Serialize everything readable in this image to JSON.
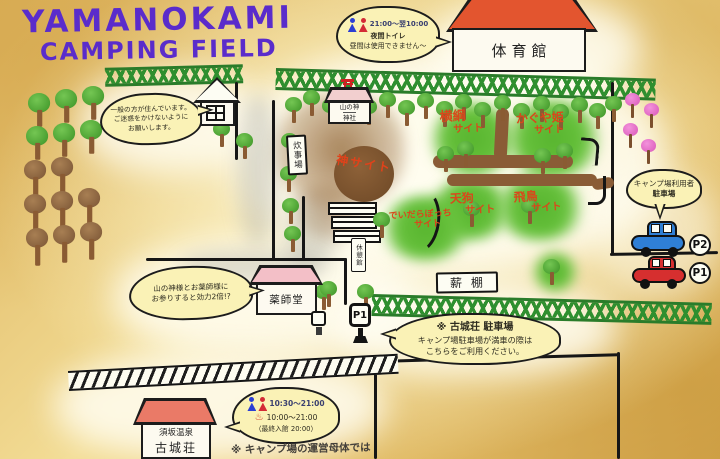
{
  "title": {
    "line1": "YAMANOKAMI",
    "line2": "CAMPING FIELD"
  },
  "buildings": {
    "gym": "体育館",
    "shrine_line1": "山の神",
    "shrine_line2": "神社",
    "cooking": "炊事場",
    "rest_hut": "休憩館",
    "yakushido": "薬師堂",
    "woodshed": "薪棚",
    "kojoso_line1": "須坂温泉",
    "kojoso_line2": "古城荘"
  },
  "sites": {
    "kami": "神サイト",
    "yokozuna": "横綱",
    "kaguya": "かぐや姫",
    "tengu": "天狗",
    "asuka": "飛鳥",
    "deidarabotchi": "でいだらぼっち",
    "suffix": "サイト"
  },
  "bubbles": {
    "night_toilet": {
      "time": "21:00〜翌10:00",
      "line1": "夜間トイレ",
      "line2": "昼間は使用できません〜"
    },
    "residents": {
      "line1": "一般の方が住んでいます。",
      "line2": "ご迷惑をかけないように",
      "line3": "お願いします。"
    },
    "pray": {
      "line1": "山の神様とお薬師様に",
      "line2": "お参りすると効力2倍!?"
    },
    "camp_parking": {
      "line1": "キャンプ場利用者",
      "line2": "駐車場"
    },
    "overflow_parking": {
      "line1": "※ 古城荘 駐車場",
      "line2": "キャンプ場駐車場が満車の際は",
      "line3": "こちらをご利用ください。"
    },
    "onsen_hours": {
      "toilet_time": "10:30〜21:00",
      "onsen_mark": "♨",
      "onsen_time": "10:00〜21:00",
      "last_entry": "（最終入館 20:00）"
    }
  },
  "parking": {
    "p2_badge": "P2",
    "p1_badge": "P1",
    "p1_sign": "P1"
  },
  "footnote": "※ キャンプ場の運営母体では",
  "colors": {
    "title_purple": "#5a2ccb",
    "site_label_red": "#d9481b",
    "fence_green": "#2f8f2f",
    "bubble_yellow": "#faf2b6",
    "gym_roof_orange": "#e3552f",
    "shrine_roof_pink": "#f2cfcf",
    "yakushido_roof_pink": "#f3bfc7",
    "kojoso_roof_salmon": "#ea7a67",
    "car_blue": "#2f7fd6",
    "car_red": "#d62f2f",
    "kami_mound_brown": "#8a5e36"
  }
}
